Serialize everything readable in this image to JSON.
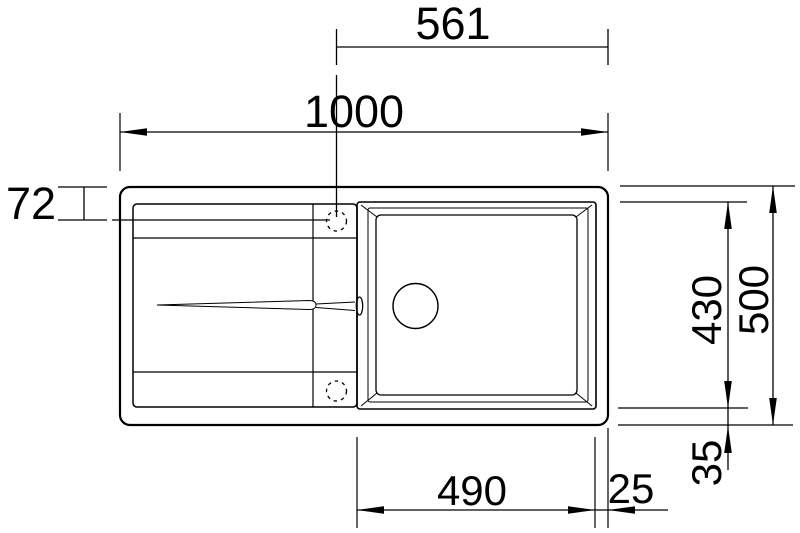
{
  "page": {
    "background": "#ffffff",
    "line_color": "#000000"
  },
  "dimensions": {
    "faucet_to_right_edge": "561",
    "overall_width": "1000",
    "faucet_offset_from_top": "72",
    "bowl_depth": "430",
    "overall_depth": "500",
    "bottom_margin": "35",
    "bowl_width": "490",
    "right_margin": "25"
  }
}
